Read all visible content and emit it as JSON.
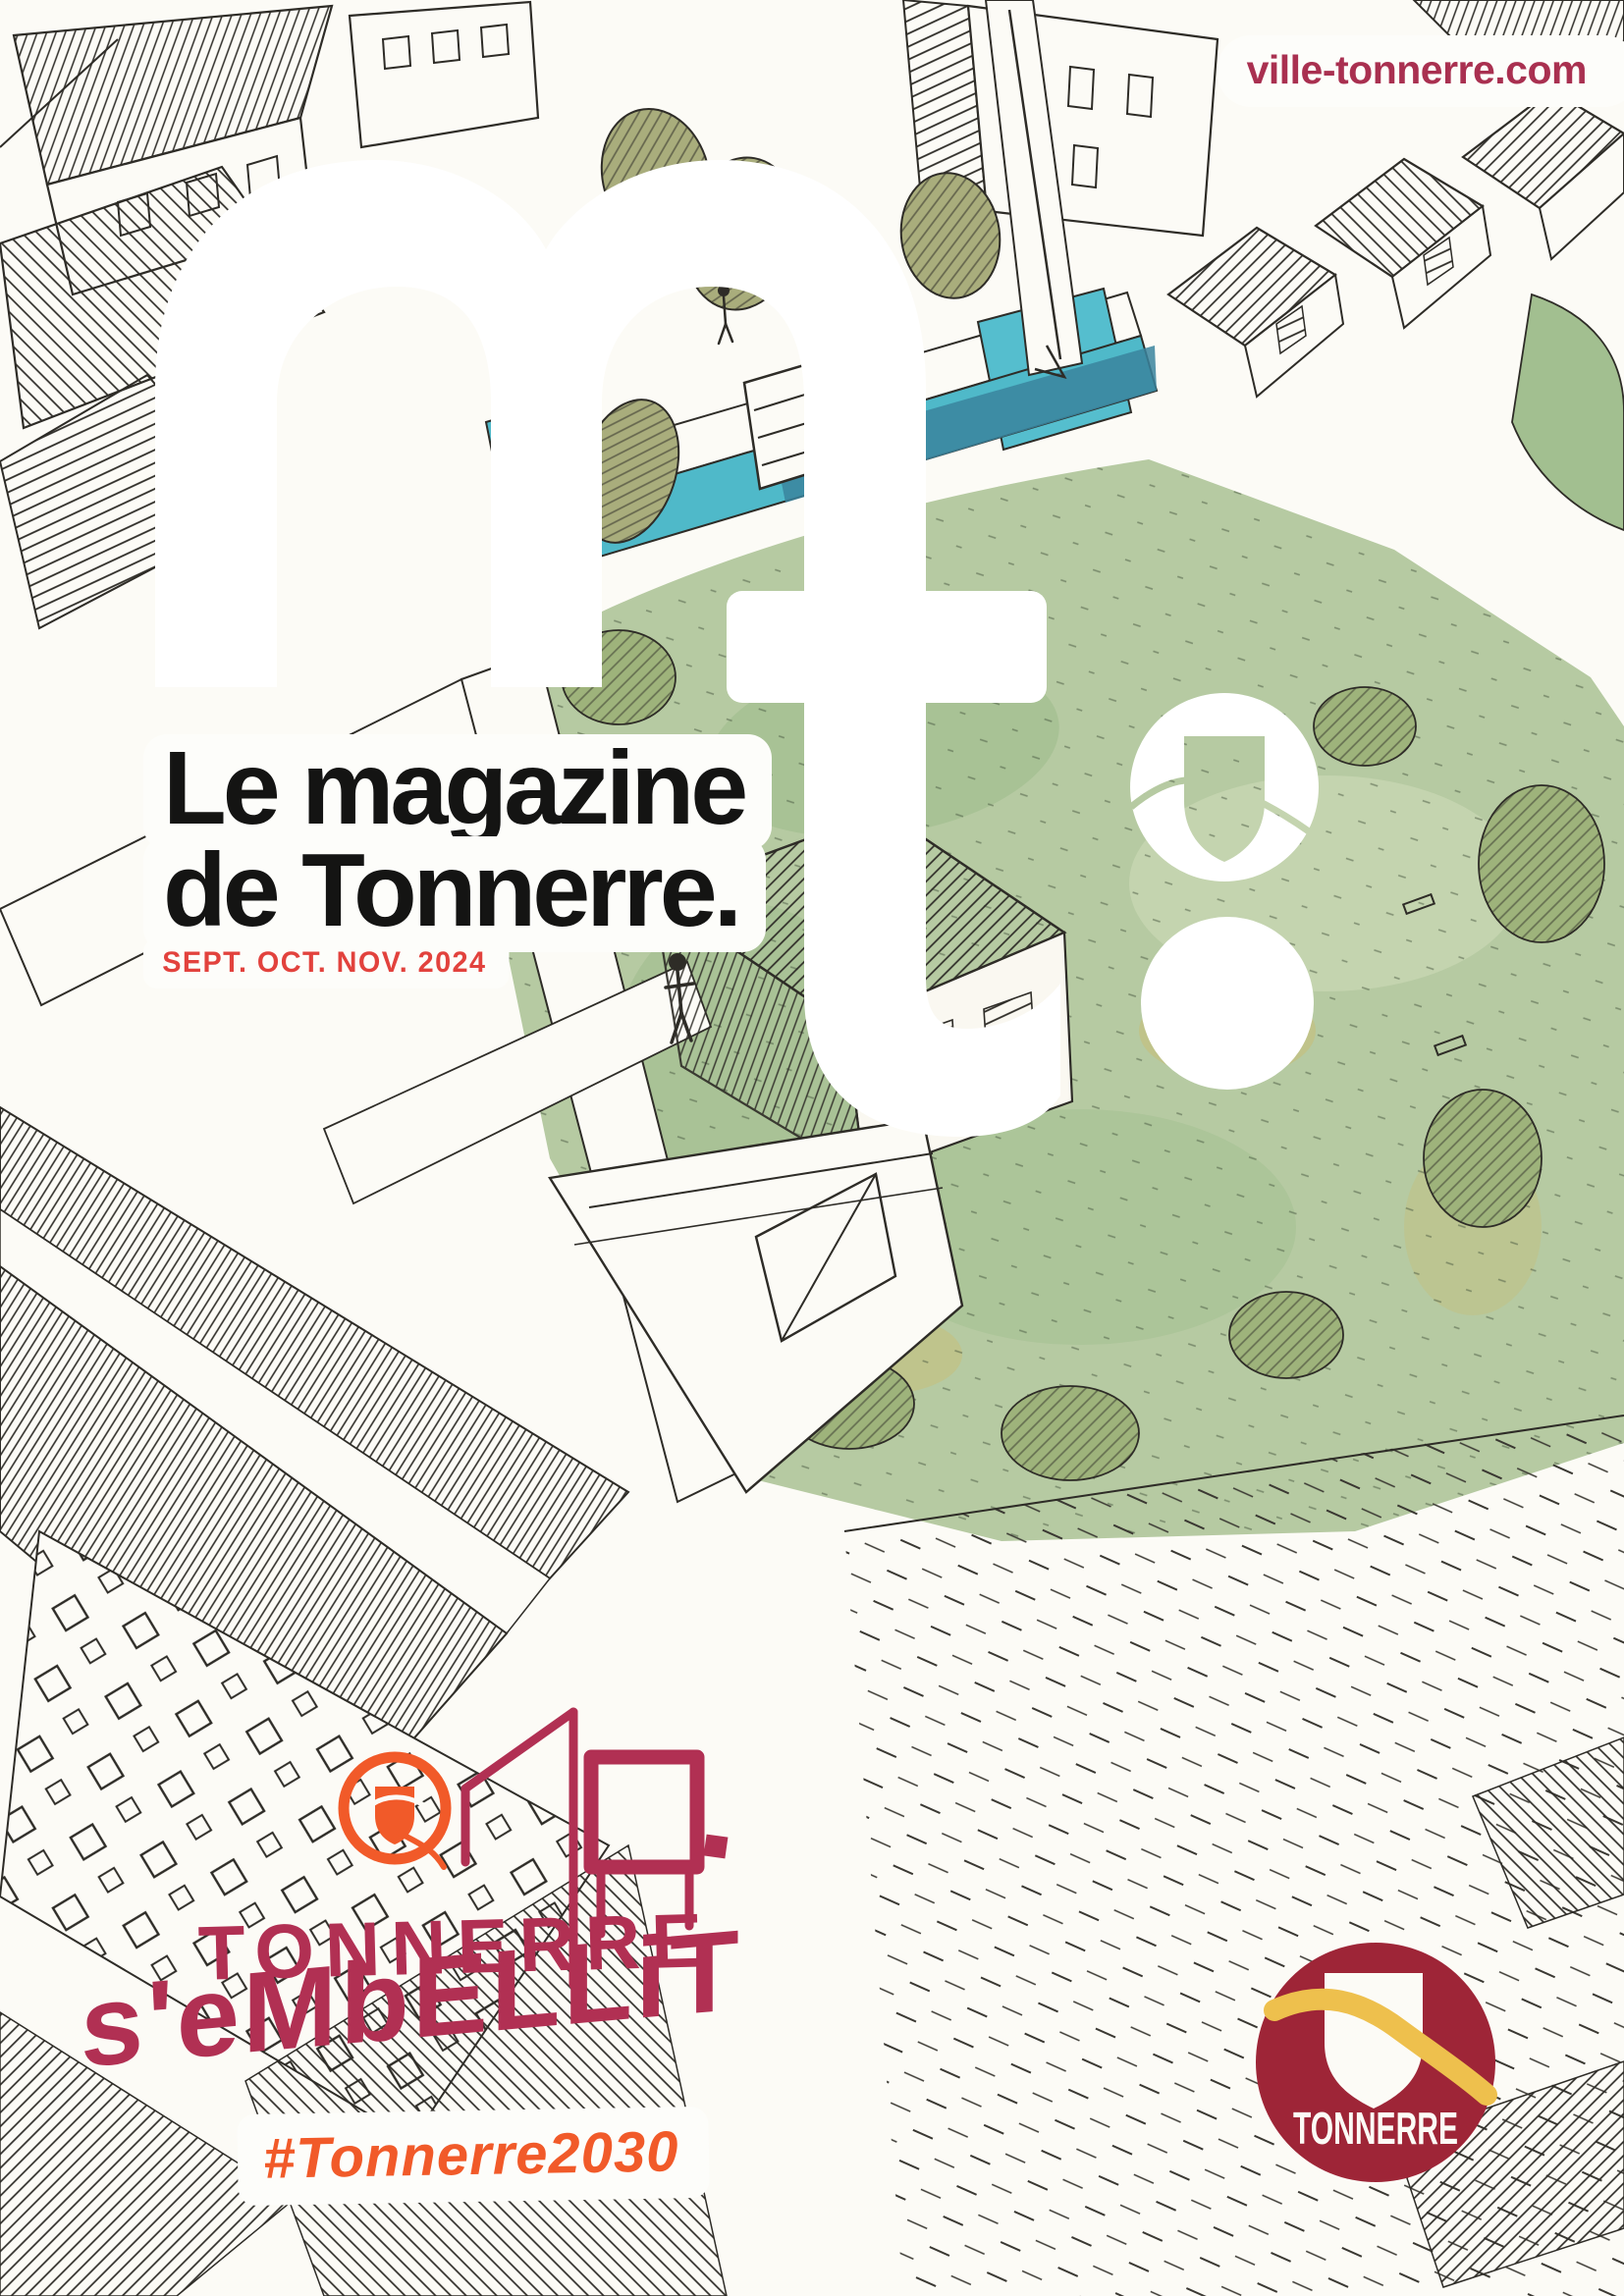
{
  "page": {
    "kind": "municipal magazine cover"
  },
  "header": {
    "website_url": "ville-tonnerre.com"
  },
  "masthead": {
    "logo_letters": "mt.",
    "title_line1": "Le magazine",
    "title_line2": "de Tonnerre.",
    "issue_date": "SEPT. OCT. NOV. 2024"
  },
  "campaign": {
    "title": "TONNERRE",
    "subtitle": "s'eMbELLiT",
    "hashtag": "#Tonnerre2030"
  },
  "city_logo": {
    "label": "TONNERRE"
  },
  "colors": {
    "url_crimson": "#a93050",
    "date_red": "#e2423d",
    "campaign_raspberry": "#b13053",
    "campaign_orange": "#f15a29",
    "city_logo_maroon": "#9e2537",
    "city_logo_gold": "#eec04d",
    "canal_teal": "#4fb9c9",
    "park_green": "#b6caa2",
    "ink": "#2e2c27",
    "paper": "#fcfbf6"
  }
}
